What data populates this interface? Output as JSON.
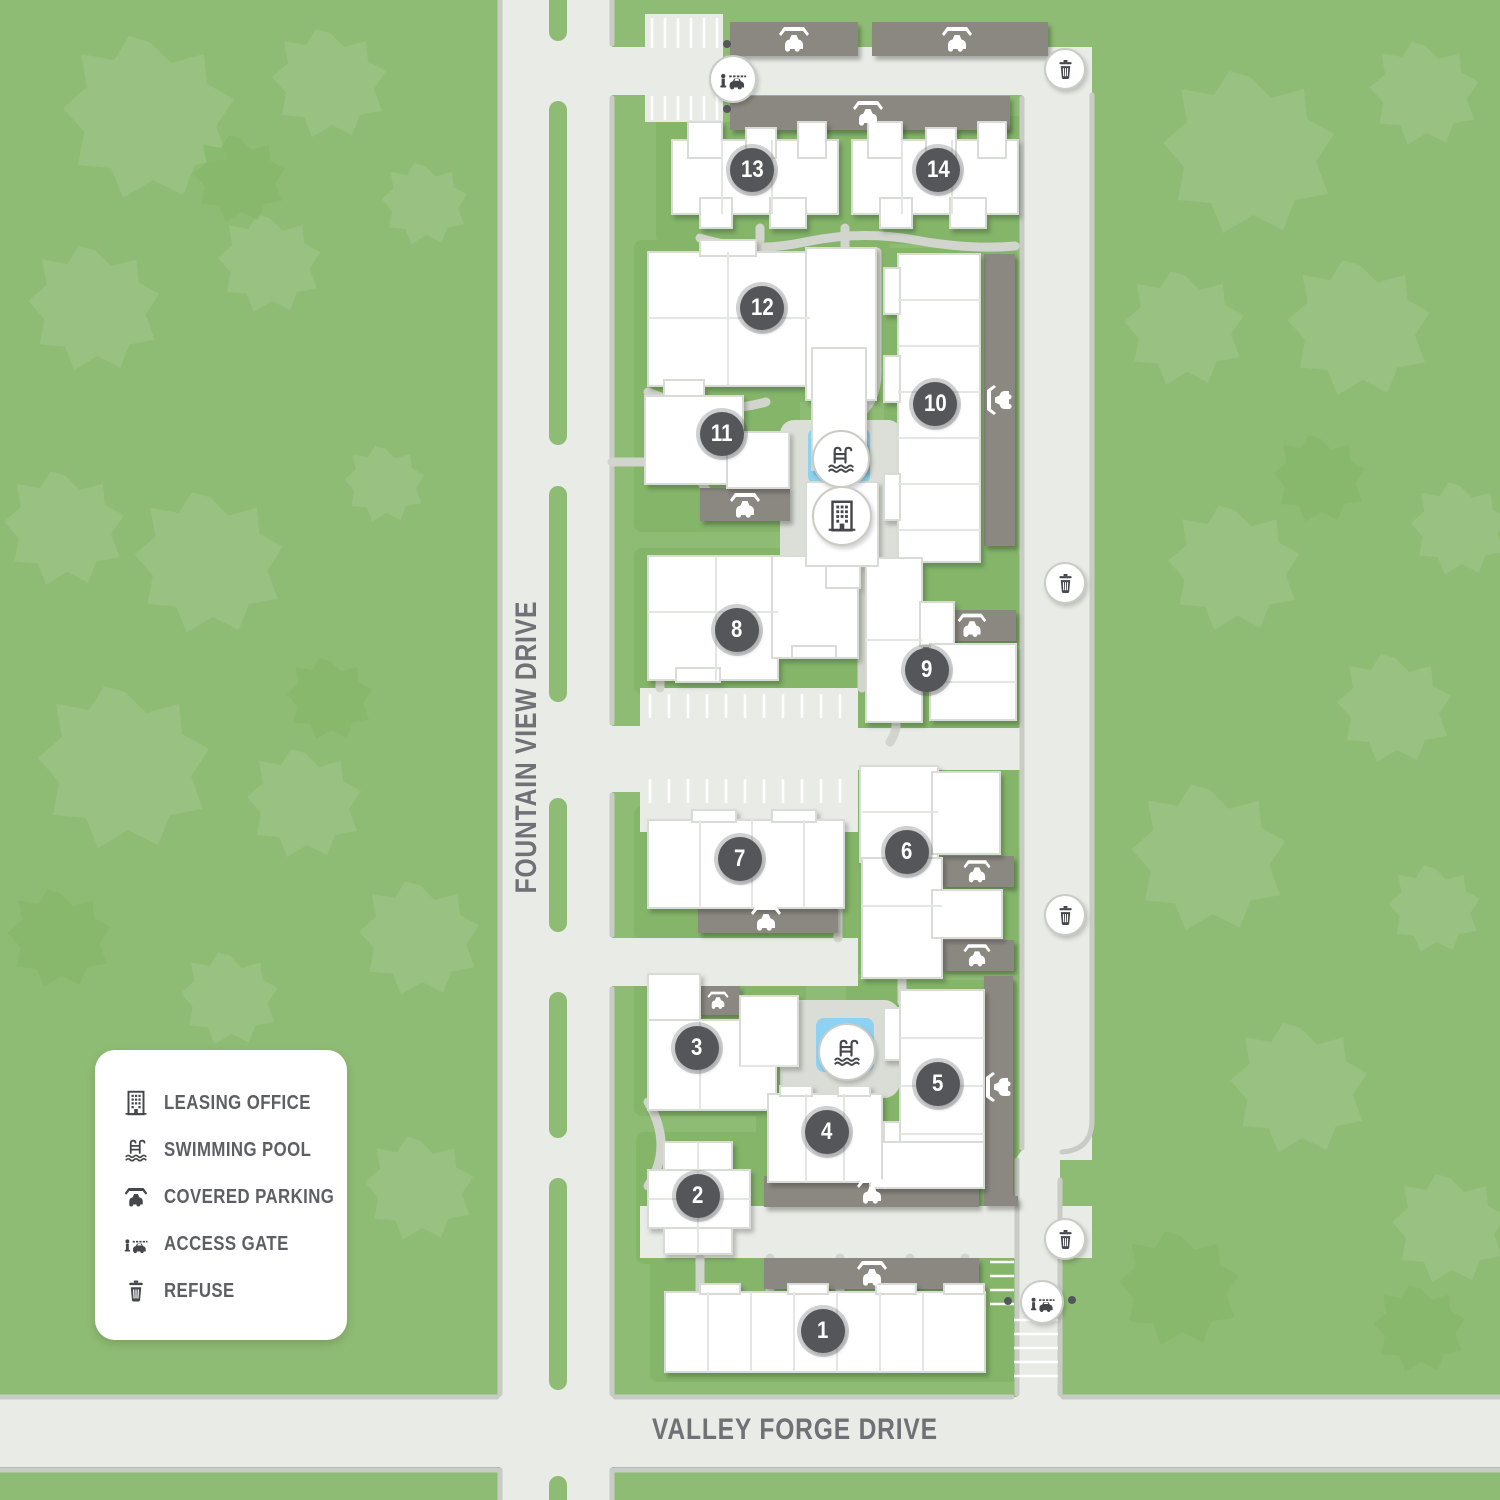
{
  "streets": {
    "vertical": "FOUNTAIN VIEW DRIVE",
    "horizontal": "VALLEY FORGE DRIVE"
  },
  "buildings": [
    {
      "number": "1"
    },
    {
      "number": "2"
    },
    {
      "number": "3"
    },
    {
      "number": "4"
    },
    {
      "number": "5"
    },
    {
      "number": "6"
    },
    {
      "number": "7"
    },
    {
      "number": "8"
    },
    {
      "number": "9"
    },
    {
      "number": "10"
    },
    {
      "number": "11"
    },
    {
      "number": "12"
    },
    {
      "number": "13"
    },
    {
      "number": "14"
    }
  ],
  "legend": {
    "items": [
      {
        "icon": "leasing-office-icon",
        "label": "LEASING OFFICE"
      },
      {
        "icon": "swimming-pool-icon",
        "label": "SWIMMING POOL"
      },
      {
        "icon": "covered-parking-icon",
        "label": "COVERED PARKING"
      },
      {
        "icon": "access-gate-icon",
        "label": "ACCESS GATE"
      },
      {
        "icon": "refuse-icon",
        "label": "REFUSE"
      }
    ]
  },
  "amenities": {
    "swimming_pools": 2,
    "leasing_offices": 1,
    "access_gates": 2,
    "refuse_stations": 4
  },
  "palette": {
    "background_green": "#8fbc74",
    "tree_green_light": "#9cc285",
    "tree_green_dark": "#84b76a",
    "lawn_dark": "#84b569",
    "road_gray": "#e9ebe7",
    "deck_gray": "#dadcd6",
    "curb_gray": "#c9ccc5",
    "path_gray": "#d2d5cd",
    "building_white": "#ffffff",
    "building_outline": "#d9dbd6",
    "parking_structure": "#8b8781",
    "pool_blue": "#8ed2f3",
    "marker_dark": "#54565a"
  }
}
